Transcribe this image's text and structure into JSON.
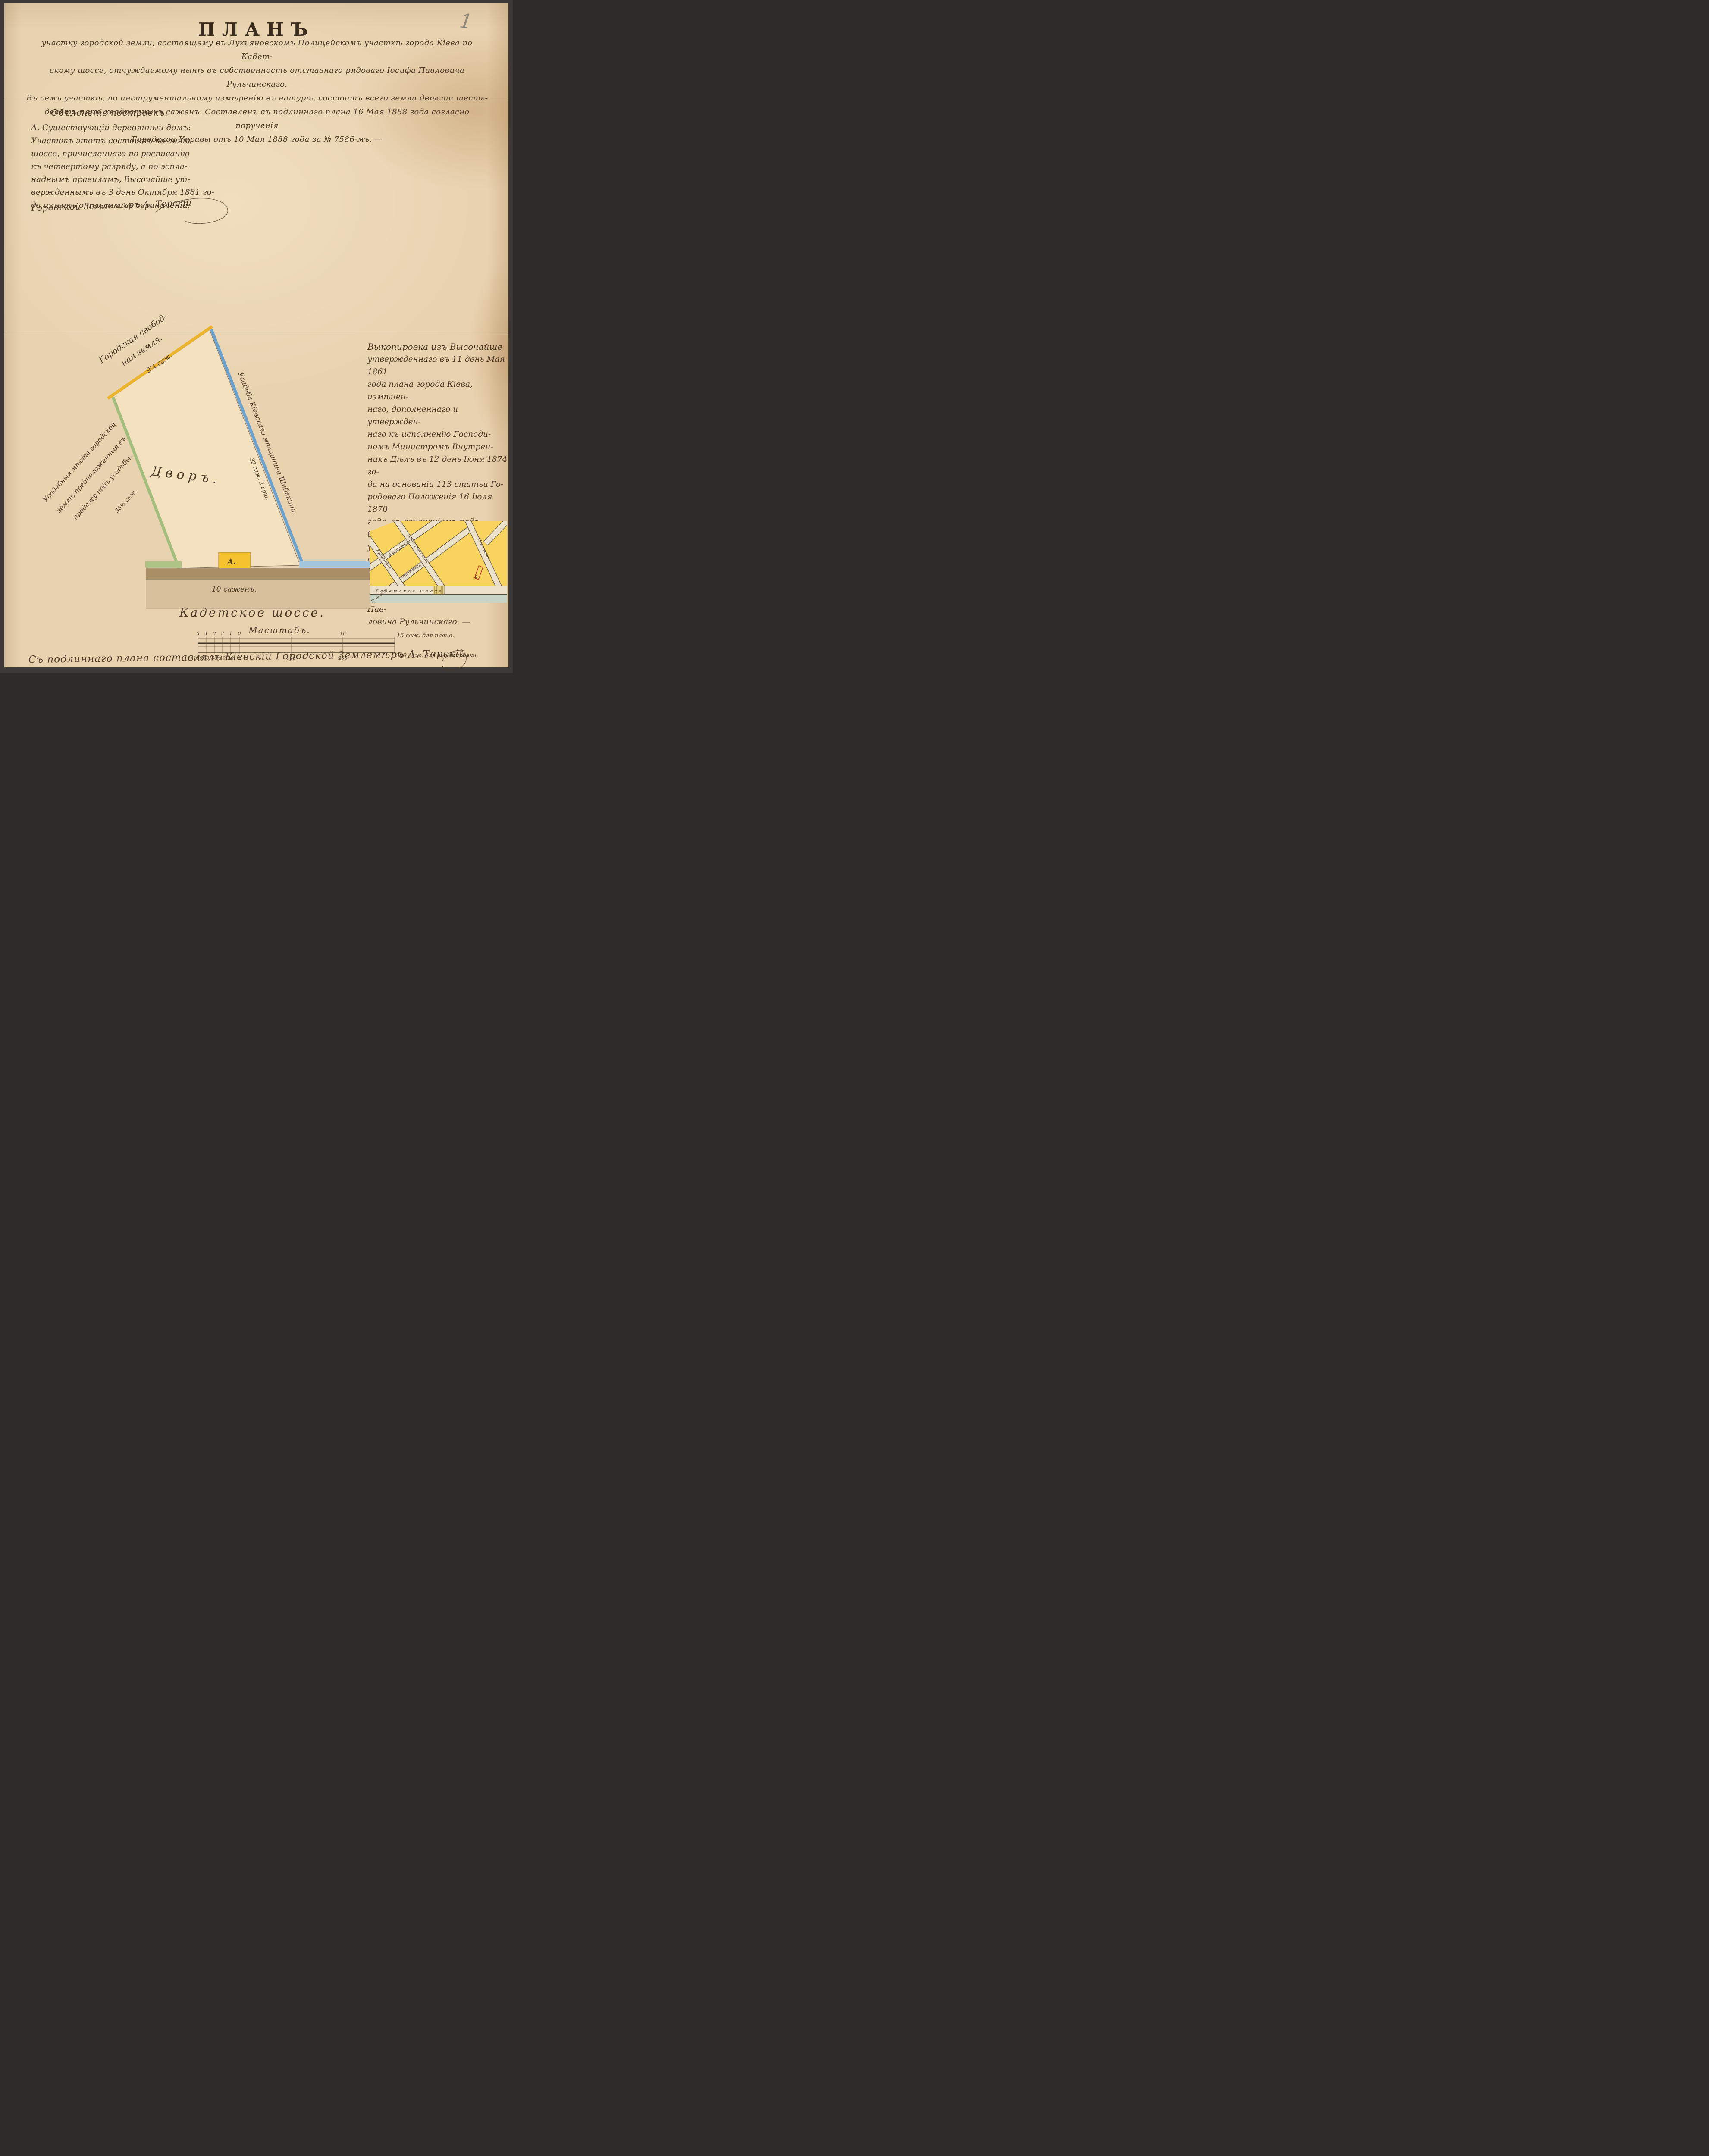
{
  "page": {
    "pencil_number": "1"
  },
  "title": "ПЛАНЪ",
  "header": {
    "lines": [
      "участку городской земли, состоящему въ Лукьяновскомъ Полицейскомъ участкѣ города Кіева по Кадет-",
      "скому шоссе, отчуждаемому нынѣ въ собственность отставнаго рядоваго Іосифа Павловича Рульчинскаго.",
      "Въ семъ участкѣ, по инструментальному измѣренію въ натурѣ, состоитъ всего земли двѣсти шесть-",
      "десятъ пять квадратныхъ саженъ. Составленъ съ подлиннаго плана 16 Мая 1888 года согласно порученія",
      "Городской Управы отъ 10 Мая 1888 года за № 7586-мъ. —"
    ]
  },
  "explanation": {
    "heading": "Объясненіе построекъ:",
    "lines": [
      "А. Существующій деревянный домъ:",
      "Участокъ этотъ состоитъ по линіи",
      "шоссе, причисленнаго по росписанію",
      "къ четвертому разряду, а по эспла-",
      "наднымъ правиламъ, Высочайше ут-",
      "вержденнымъ въ 3 день Октября 1881 го-",
      "да изъятъ отъ всякихъ ограниченій."
    ],
    "signature": "Городской Землемѣръ А. Терскій"
  },
  "right_note": {
    "lines": [
      "Выкопировка изъ Высочайше",
      "утвержденнаго въ 11 день Мая 1861",
      "года плана города Кіева, измѣнен-",
      "наго, дополненнаго и утвержден-",
      "наго къ исполненію Господи-",
      "номъ Министромъ Внутрен-",
      "нихъ Дѣлъ въ 12 день Іюня 1874 го-",
      "да на основаніи 113 статьи Го-",
      "родоваго Положенія 16 Іюля 1870",
      "года, съ означеніемъ подъ буквою А",
      "участка городской земли, отчуж-",
      "даемаго нынѣ въ собственность",
      "отставнаго рядоваго Іосифа Пав-",
      "ловича Рульчинскаго. —"
    ]
  },
  "plan": {
    "yard_label": "Дворъ.",
    "building_label": "А.",
    "frontage": "10 саженъ.",
    "road": "Кадетское шоссе.",
    "top_boundary": {
      "line1": "Городская свобод-",
      "line2": "ная земля.",
      "measure": "9¼ саж."
    },
    "right_boundary": {
      "label": "Усадьба Кіевскаго мѣщанина Шебякина.",
      "measure": "32 саж. 2 арш."
    },
    "left_boundary": {
      "lines": [
        "Усадебныя мѣста городской",
        "земли, предположенныя въ",
        "продажу подъ усадьбы."
      ],
      "measure": "36½ саж."
    }
  },
  "scale_bar": {
    "title": "Масштабъ.",
    "top_ticks": [
      "5",
      "4",
      "3",
      "2",
      "1",
      "0",
      "5",
      "10"
    ],
    "right_top": "15 саж. для плана.",
    "bottom_ticks": [
      "100",
      "80",
      "60",
      "40",
      "20",
      "0",
      "100",
      "200"
    ],
    "right_bottom": "300 саж. для выкопировки."
  },
  "inset": {
    "highway": "Кадетское шоссе",
    "marker": "а",
    "streets": [
      "Дмитріевская",
      "Жилянская",
      "Галицкая",
      "Кудрявская",
      "Златоустовская",
      "Павловская"
    ]
  },
  "footer": {
    "signature": "Съ подлиннаго плана составлялъ Кіевскій Городской Землемѣръ А. Терскій."
  },
  "colors": {
    "frame": "#3c3936",
    "paper": "#e8d2af",
    "ink": "#4a3724",
    "pencil": "#8f897a",
    "yellow_line": "#ecb32c",
    "blue_line": "#6aa2cf",
    "blue_foot": "#a3c6de",
    "green_line": "#a3bd7c",
    "green_foot": "#aec487",
    "parcel_fill": "#f3e1c0",
    "building": "#f5c330",
    "road_brown": "#a98e66",
    "road_tan": "#d8c09c",
    "inset_yellow": "#f8d45f",
    "inset_street": "#ece2cc",
    "inset_field": "#c8d5c6",
    "marker_red": "#c93b2e"
  }
}
